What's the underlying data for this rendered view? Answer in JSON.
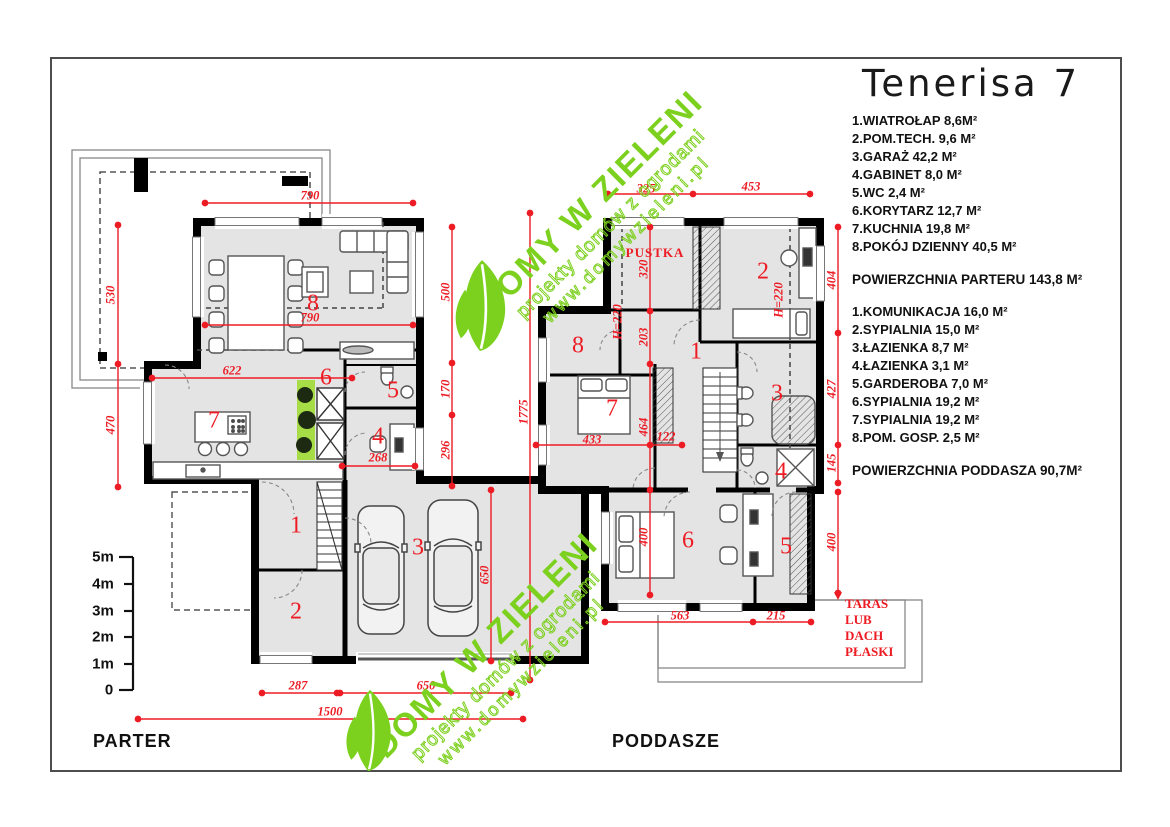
{
  "title": "Tenerisa 7",
  "legend": {
    "parter_rooms": [
      "1.WIATROŁAP  8,6M²",
      "2.POM.TECH. 9,6 M²",
      "3.GARAŻ 42,2 M²",
      "4.GABINET 8,0 M²",
      "5.WC  2,4 M²",
      "6.KORYTARZ 12,7 M²",
      "7.KUCHNIA 19,8 M²",
      "8.POKÓJ DZIENNY 40,5 M²"
    ],
    "parter_total": "POWIERZCHNIA PARTERU   143,8 M²",
    "poddasze_rooms": [
      "1.KOMUNIKACJA 16,0  M²",
      "2.SYPIALNIA 15,0 M²",
      "3.ŁAZIENKA 8,7  M²",
      "4.ŁAZIENKA 3,1 M²",
      "5.GARDEROBA 7,0  M²",
      "6.SYPIALNIA 19,2 M²",
      "7.SYPIALNIA 19,2 M²",
      "8.POM. GOSP. 2,5 M²"
    ],
    "poddasze_total": "POWIERZCHNIA PODDASZA  90,7M²"
  },
  "plans": {
    "parter": {
      "label": "PARTER",
      "room_numbers": [
        {
          "t": "8",
          "x": 313,
          "y": 304
        },
        {
          "t": "6",
          "x": 326,
          "y": 378
        },
        {
          "t": "5",
          "x": 393,
          "y": 391
        },
        {
          "t": "7",
          "x": 214,
          "y": 421
        },
        {
          "t": "4",
          "x": 378,
          "y": 437
        },
        {
          "t": "1",
          "x": 296,
          "y": 526
        },
        {
          "t": "3",
          "x": 418,
          "y": 548
        },
        {
          "t": "2",
          "x": 296,
          "y": 612
        }
      ],
      "dimensions": [
        {
          "t": "790",
          "x": 310,
          "y": 196
        },
        {
          "t": "790",
          "x": 310,
          "y": 318
        },
        {
          "t": "530",
          "x": 111,
          "y": 295,
          "r": -90
        },
        {
          "t": "470",
          "x": 111,
          "y": 425,
          "r": -90
        },
        {
          "t": "622",
          "x": 232,
          "y": 371
        },
        {
          "t": "268",
          "x": 378,
          "y": 458
        },
        {
          "t": "500",
          "x": 446,
          "y": 292,
          "r": -90
        },
        {
          "t": "170",
          "x": 446,
          "y": 389,
          "r": -90
        },
        {
          "t": "296",
          "x": 446,
          "y": 450,
          "r": -90
        },
        {
          "t": "650",
          "x": 485,
          "y": 575,
          "r": -90
        },
        {
          "t": "1775",
          "x": 524,
          "y": 412,
          "r": -90
        },
        {
          "t": "287",
          "x": 298,
          "y": 686
        },
        {
          "t": "650",
          "x": 426,
          "y": 686
        },
        {
          "t": "1500",
          "x": 330,
          "y": 712
        }
      ]
    },
    "poddasze": {
      "label": "PODDASZE",
      "pustka_label": "PUSTKA",
      "taras_note": [
        {
          "t": "TARAS",
          "x": 845,
          "y": 604,
          "align": "left"
        },
        {
          "t": "LUB",
          "x": 845,
          "y": 620,
          "align": "left"
        },
        {
          "t": "DACH",
          "x": 845,
          "y": 636,
          "align": "left"
        },
        {
          "t": "PŁASKI",
          "x": 845,
          "y": 652,
          "align": "left"
        }
      ],
      "room_numbers": [
        {
          "t": "8",
          "x": 578,
          "y": 346
        },
        {
          "t": "7",
          "x": 612,
          "y": 409
        },
        {
          "t": "1",
          "x": 696,
          "y": 352
        },
        {
          "t": "2",
          "x": 763,
          "y": 272
        },
        {
          "t": "3",
          "x": 777,
          "y": 394
        },
        {
          "t": "4",
          "x": 781,
          "y": 472
        },
        {
          "t": "6",
          "x": 688,
          "y": 541
        },
        {
          "t": "5",
          "x": 786,
          "y": 547
        }
      ],
      "dimensions": [
        {
          "t": "325",
          "x": 646,
          "y": 189
        },
        {
          "t": "453",
          "x": 751,
          "y": 187
        },
        {
          "t": "404",
          "x": 832,
          "y": 280,
          "r": -90
        },
        {
          "t": "427",
          "x": 832,
          "y": 389,
          "r": -90
        },
        {
          "t": "145",
          "x": 832,
          "y": 463,
          "r": -90
        },
        {
          "t": "400",
          "x": 832,
          "y": 542,
          "r": -90
        },
        {
          "t": "320",
          "x": 644,
          "y": 269,
          "r": -90
        },
        {
          "t": "203",
          "x": 644,
          "y": 337,
          "r": -90
        },
        {
          "t": "464",
          "x": 644,
          "y": 427,
          "r": -90
        },
        {
          "t": "400",
          "x": 644,
          "y": 537,
          "r": -90
        },
        {
          "t": "433",
          "x": 592,
          "y": 440
        },
        {
          "t": "122",
          "x": 666,
          "y": 437
        },
        {
          "t": "563",
          "x": 680,
          "y": 616
        },
        {
          "t": "215",
          "x": 776,
          "y": 616
        },
        {
          "t": "H=220",
          "x": 618,
          "y": 322,
          "r": -90
        },
        {
          "t": "H=220",
          "x": 779,
          "y": 300,
          "r": -90
        }
      ]
    }
  },
  "scale_bar": {
    "labels": [
      {
        "t": "5m",
        "x": 103,
        "y": 557
      },
      {
        "t": "4m",
        "x": 103,
        "y": 584
      },
      {
        "t": "3m",
        "x": 103,
        "y": 611
      },
      {
        "t": "2m",
        "x": 103,
        "y": 637
      },
      {
        "t": "1m",
        "x": 103,
        "y": 664
      },
      {
        "t": "0",
        "x": 109,
        "y": 690
      }
    ]
  },
  "watermark": {
    "line1": "DOMY W ZIELENI",
    "line2": "projekty domów z ogrodami",
    "line3": "www.domywzieleni.pl"
  },
  "colors": {
    "dimension_red": "#ed1c24",
    "watermark_green": "#7cd01e",
    "wall_black": "#000000",
    "room_fill": "#e4e4e4"
  }
}
